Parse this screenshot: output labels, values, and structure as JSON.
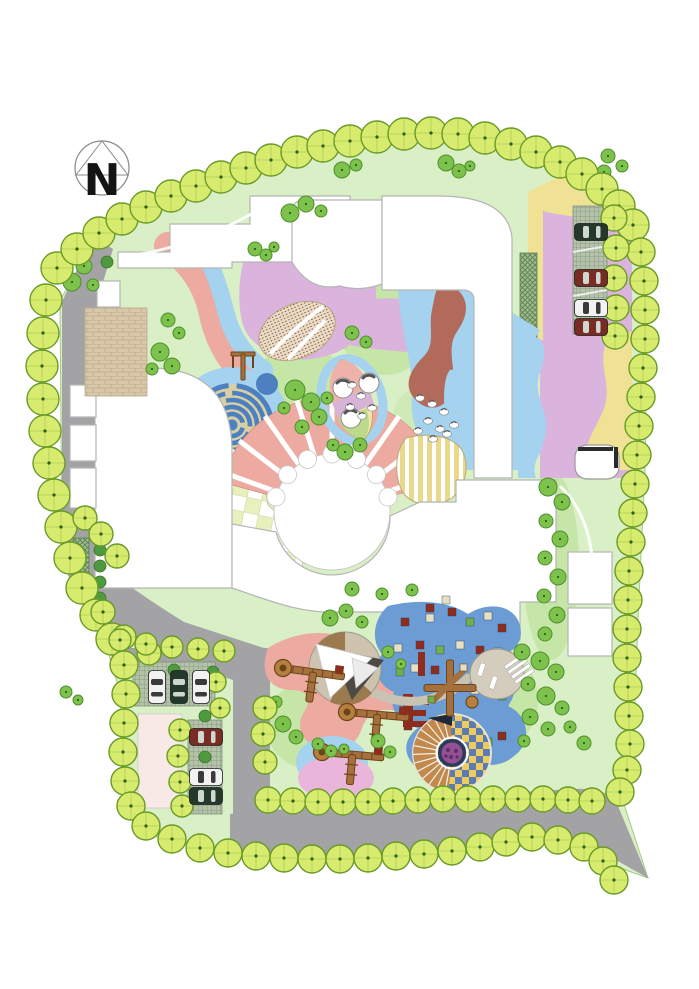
{
  "meta": {
    "plan_type": "landscape-site-plan",
    "canvas": {
      "width": 699,
      "height": 989
    }
  },
  "compass": {
    "label": "N"
  },
  "palette": {
    "lawn": "#d9efc5",
    "lawnAccent": "#c6e6a8",
    "lawnEdge": "#a4ca82",
    "road": "#a3a3a5",
    "roadEdge": "#8e8e90",
    "treeBorderFill": "#d7eb6e",
    "treeBorderStroke": "#6b9a28",
    "treeDot": "#2f5e14",
    "treeInterior": "#7dc24d",
    "treeInteriorStroke": "#4f8f2b",
    "bush": "#4f9a3f",
    "salmon": "#ecaaa0",
    "lilac": "#dab4dc",
    "pinkPurple": "#eab5da",
    "lightBlue": "#a5d2ee",
    "mazeBlue": "#4d80c0",
    "mazeSand": "#d8cfa4",
    "maroon": "#b26a5b",
    "yellow": "#efe294",
    "leafYellow": "#efe6a8",
    "checkerGreen": "#e8f1bd",
    "brickTan": "#d8c7a8",
    "plazaTan": "#cdc3ae",
    "mound": "#d4ccbd",
    "bluePlaza": "#6c9cd4",
    "mosaicGold": "#eecb5e",
    "mosaicBlue": "#5b7cb2",
    "arcBrown": "#c1894e",
    "flowerPurple": "#944f95",
    "flowerDark": "#5c2f66",
    "equipBrown": "#a5703d",
    "equipDark": "#6b4418",
    "carGreen": "#24382c",
    "carRed": "#7a2b24",
    "carWhite": "#f2f2f2",
    "blockPink": "#f6e9e6",
    "building": "#ffffff",
    "buildingStroke": "#b5b5b5",
    "squareRed": "#8e2d1d",
    "squareTan": "#e6dfc3",
    "squareGreen": "#6faf4c"
  },
  "trees": {
    "border": [
      [
        57,
        268
      ],
      [
        77,
        249
      ],
      [
        99,
        233
      ],
      [
        122,
        219
      ],
      [
        146,
        207
      ],
      [
        171,
        196
      ],
      [
        196,
        186
      ],
      [
        221,
        177
      ],
      [
        246,
        168
      ],
      [
        271,
        160
      ],
      [
        297,
        152
      ],
      [
        323,
        146
      ],
      [
        350,
        141
      ],
      [
        377,
        137
      ],
      [
        404,
        134
      ],
      [
        431,
        133
      ],
      [
        458,
        134
      ],
      [
        485,
        138
      ],
      [
        511,
        144
      ],
      [
        536,
        152
      ],
      [
        560,
        162
      ],
      [
        582,
        174
      ],
      [
        602,
        189
      ],
      [
        619,
        206
      ],
      [
        633,
        225
      ],
      [
        46,
        300
      ],
      [
        43,
        333
      ],
      [
        42,
        366
      ],
      [
        43,
        399
      ],
      [
        45,
        431
      ],
      [
        49,
        463
      ],
      [
        54,
        495
      ],
      [
        61,
        527
      ],
      [
        70,
        558
      ],
      [
        82,
        588
      ],
      [
        96,
        615
      ],
      [
        112,
        639
      ],
      [
        124,
        665,
        14
      ],
      [
        126,
        694,
        14
      ],
      [
        124,
        723,
        14
      ],
      [
        123,
        752,
        14
      ],
      [
        125,
        781,
        14
      ],
      [
        131,
        806,
        14
      ],
      [
        146,
        826,
        14
      ],
      [
        172,
        839,
        14
      ],
      [
        200,
        848,
        14
      ],
      [
        228,
        853,
        14
      ],
      [
        256,
        856,
        14
      ],
      [
        284,
        858,
        14
      ],
      [
        312,
        859,
        14
      ],
      [
        340,
        859,
        14
      ],
      [
        368,
        858,
        14
      ],
      [
        396,
        856,
        14
      ],
      [
        424,
        854,
        14
      ],
      [
        452,
        851,
        14
      ],
      [
        480,
        847,
        14
      ],
      [
        506,
        842,
        14
      ],
      [
        532,
        837,
        14
      ],
      [
        558,
        840,
        14
      ],
      [
        584,
        847,
        14
      ],
      [
        603,
        861,
        14
      ],
      [
        614,
        880,
        14
      ],
      [
        268,
        800,
        13
      ],
      [
        293,
        801,
        13
      ],
      [
        318,
        802,
        13
      ],
      [
        343,
        802,
        13
      ],
      [
        368,
        802,
        13
      ],
      [
        393,
        801,
        13
      ],
      [
        418,
        800,
        13
      ],
      [
        443,
        799,
        13
      ],
      [
        468,
        799,
        13
      ],
      [
        493,
        799,
        13
      ],
      [
        518,
        799,
        13
      ],
      [
        543,
        799,
        13
      ],
      [
        568,
        800,
        13
      ],
      [
        592,
        801,
        13
      ],
      [
        641,
        252,
        14
      ],
      [
        644,
        281,
        14
      ],
      [
        645,
        310,
        14
      ],
      [
        645,
        339,
        14
      ],
      [
        643,
        368,
        14
      ],
      [
        641,
        397,
        14
      ],
      [
        639,
        426,
        14
      ],
      [
        637,
        455,
        14
      ],
      [
        635,
        484,
        14
      ],
      [
        633,
        513,
        14
      ],
      [
        631,
        542,
        14
      ],
      [
        629,
        571,
        14
      ],
      [
        628,
        600,
        14
      ],
      [
        627,
        629,
        14
      ],
      [
        627,
        658,
        14
      ],
      [
        628,
        687,
        14
      ],
      [
        629,
        716,
        14
      ],
      [
        630,
        744,
        14
      ],
      [
        627,
        770,
        14
      ],
      [
        620,
        792,
        14
      ],
      [
        614,
        218,
        13
      ],
      [
        616,
        248,
        13
      ],
      [
        614,
        278,
        13
      ],
      [
        616,
        308,
        13
      ],
      [
        615,
        336,
        13
      ],
      [
        85,
        518,
        12
      ],
      [
        101,
        534,
        12
      ],
      [
        117,
        556,
        12
      ],
      [
        103,
        612,
        12
      ],
      [
        124,
        637,
        12
      ],
      [
        149,
        653,
        12
      ],
      [
        120,
        640,
        11
      ],
      [
        146,
        644,
        11
      ],
      [
        172,
        647,
        11
      ],
      [
        198,
        649,
        11
      ],
      [
        224,
        651,
        11
      ],
      [
        265,
        708,
        12
      ],
      [
        263,
        734,
        12
      ],
      [
        265,
        762,
        12
      ],
      [
        180,
        730,
        11
      ],
      [
        178,
        756,
        11
      ],
      [
        180,
        782,
        11
      ],
      [
        182,
        806,
        11
      ],
      [
        216,
        682,
        10
      ],
      [
        220,
        708,
        10
      ]
    ],
    "interior": [
      [
        84,
        266,
        8
      ],
      [
        72,
        282,
        9
      ],
      [
        93,
        285,
        6
      ],
      [
        255,
        249,
        7
      ],
      [
        266,
        255,
        6
      ],
      [
        274,
        247,
        5
      ],
      [
        290,
        213,
        9
      ],
      [
        306,
        204,
        8
      ],
      [
        321,
        211,
        6
      ],
      [
        342,
        170,
        8
      ],
      [
        356,
        165,
        6
      ],
      [
        446,
        163,
        8
      ],
      [
        459,
        171,
        7
      ],
      [
        470,
        166,
        5
      ],
      [
        590,
        182,
        9
      ],
      [
        604,
        172,
        7
      ],
      [
        608,
        156,
        7
      ],
      [
        622,
        166,
        6
      ],
      [
        160,
        352,
        9
      ],
      [
        172,
        366,
        8
      ],
      [
        152,
        369,
        6
      ],
      [
        168,
        320,
        7
      ],
      [
        179,
        333,
        6
      ],
      [
        295,
        390,
        10
      ],
      [
        311,
        402,
        9
      ],
      [
        319,
        417,
        8
      ],
      [
        302,
        427,
        7
      ],
      [
        284,
        408,
        6
      ],
      [
        327,
        398,
        6
      ],
      [
        345,
        452,
        8
      ],
      [
        360,
        445,
        7
      ],
      [
        333,
        445,
        6
      ],
      [
        352,
        333,
        7
      ],
      [
        366,
        342,
        6
      ],
      [
        548,
        487,
        9
      ],
      [
        562,
        502,
        8
      ],
      [
        546,
        521,
        7
      ],
      [
        560,
        539,
        8
      ],
      [
        545,
        558,
        7
      ],
      [
        558,
        577,
        8
      ],
      [
        544,
        596,
        7
      ],
      [
        557,
        615,
        8
      ],
      [
        545,
        634,
        7
      ],
      [
        522,
        652,
        8
      ],
      [
        540,
        661,
        9
      ],
      [
        556,
        672,
        8
      ],
      [
        528,
        684,
        7
      ],
      [
        546,
        696,
        9
      ],
      [
        562,
        708,
        7
      ],
      [
        530,
        717,
        8
      ],
      [
        548,
        729,
        7
      ],
      [
        570,
        727,
        6
      ],
      [
        584,
        743,
        7
      ],
      [
        524,
        741,
        6
      ],
      [
        330,
        618,
        8
      ],
      [
        346,
        611,
        7
      ],
      [
        362,
        622,
        6
      ],
      [
        388,
        652,
        6
      ],
      [
        401,
        664,
        5
      ],
      [
        283,
        724,
        8
      ],
      [
        296,
        737,
        7
      ],
      [
        318,
        744,
        6
      ],
      [
        331,
        751,
        6
      ],
      [
        344,
        749,
        5
      ],
      [
        378,
        741,
        7
      ],
      [
        390,
        752,
        6
      ],
      [
        276,
        702,
        6
      ],
      [
        66,
        692,
        6
      ],
      [
        78,
        700,
        5
      ],
      [
        352,
        589,
        7
      ],
      [
        382,
        594,
        6
      ],
      [
        412,
        590,
        6
      ]
    ],
    "bushes": [
      [
        100,
        534
      ],
      [
        100,
        550
      ],
      [
        100,
        566
      ],
      [
        100,
        582
      ],
      [
        100,
        598
      ],
      [
        174,
        670
      ],
      [
        213,
        672
      ],
      [
        205,
        716
      ],
      [
        205,
        757
      ],
      [
        107,
        262
      ]
    ]
  },
  "cars": [
    {
      "x": 591,
      "y": 232,
      "vertical": false,
      "color": "carGreen"
    },
    {
      "x": 591,
      "y": 278,
      "vertical": false,
      "color": "carRed"
    },
    {
      "x": 591,
      "y": 308,
      "vertical": false,
      "color": "carWhite"
    },
    {
      "x": 591,
      "y": 327,
      "vertical": false,
      "color": "carRed"
    },
    {
      "x": 157,
      "y": 687,
      "vertical": true,
      "color": "carWhite"
    },
    {
      "x": 179,
      "y": 687,
      "vertical": true,
      "color": "carGreen"
    },
    {
      "x": 201,
      "y": 687,
      "vertical": true,
      "color": "carWhite"
    },
    {
      "x": 206,
      "y": 737,
      "vertical": false,
      "color": "carRed"
    },
    {
      "x": 206,
      "y": 777,
      "vertical": false,
      "color": "carWhite"
    },
    {
      "x": 206,
      "y": 796,
      "vertical": false,
      "color": "carGreen"
    }
  ],
  "pebbles": [
    [
      352,
      385
    ],
    [
      361,
      396
    ],
    [
      350,
      407
    ],
    [
      362,
      416
    ],
    [
      372,
      408
    ],
    [
      420,
      398
    ],
    [
      432,
      404
    ],
    [
      444,
      412
    ],
    [
      428,
      421
    ],
    [
      440,
      429
    ],
    [
      454,
      425
    ],
    [
      418,
      431
    ],
    [
      433,
      439
    ],
    [
      447,
      434
    ]
  ],
  "plaza_squares": [
    [
      405,
      622,
      "r"
    ],
    [
      430,
      618,
      "t"
    ],
    [
      452,
      612,
      "r"
    ],
    [
      470,
      622,
      "g"
    ],
    [
      488,
      616,
      "t"
    ],
    [
      502,
      628,
      "r"
    ],
    [
      398,
      648,
      "t"
    ],
    [
      420,
      645,
      "r"
    ],
    [
      440,
      650,
      "g"
    ],
    [
      460,
      645,
      "t"
    ],
    [
      480,
      650,
      "r"
    ],
    [
      498,
      652,
      "t"
    ],
    [
      400,
      672,
      "g"
    ],
    [
      415,
      668,
      "t"
    ],
    [
      435,
      670,
      "r"
    ],
    [
      475,
      690,
      "t"
    ],
    [
      490,
      686,
      "r"
    ],
    [
      502,
      696,
      "g"
    ],
    [
      408,
      726,
      "r"
    ],
    [
      425,
      735,
      "t"
    ],
    [
      440,
      742,
      "r"
    ],
    [
      470,
      748,
      "t"
    ],
    [
      488,
      742,
      "g"
    ],
    [
      502,
      736,
      "r"
    ],
    [
      418,
      756,
      "g"
    ],
    [
      435,
      762,
      "r"
    ],
    [
      430,
      608,
      "r"
    ],
    [
      446,
      600,
      "t"
    ]
  ],
  "equipment": [
    {
      "type": "combo",
      "x": 283,
      "y": 668,
      "angle": 8
    },
    {
      "type": "combo",
      "x": 347,
      "y": 712,
      "angle": 5
    },
    {
      "type": "combo",
      "x": 322,
      "y": 752,
      "angle": 5
    },
    {
      "type": "cross",
      "x": 450,
      "y": 688,
      "angle": 0
    },
    {
      "type": "swing",
      "x": 243,
      "y": 366,
      "angle": 0
    }
  ],
  "stepping_balls": [
    [
      343,
      388
    ],
    [
      369,
      383
    ],
    [
      351,
      418
    ]
  ]
}
